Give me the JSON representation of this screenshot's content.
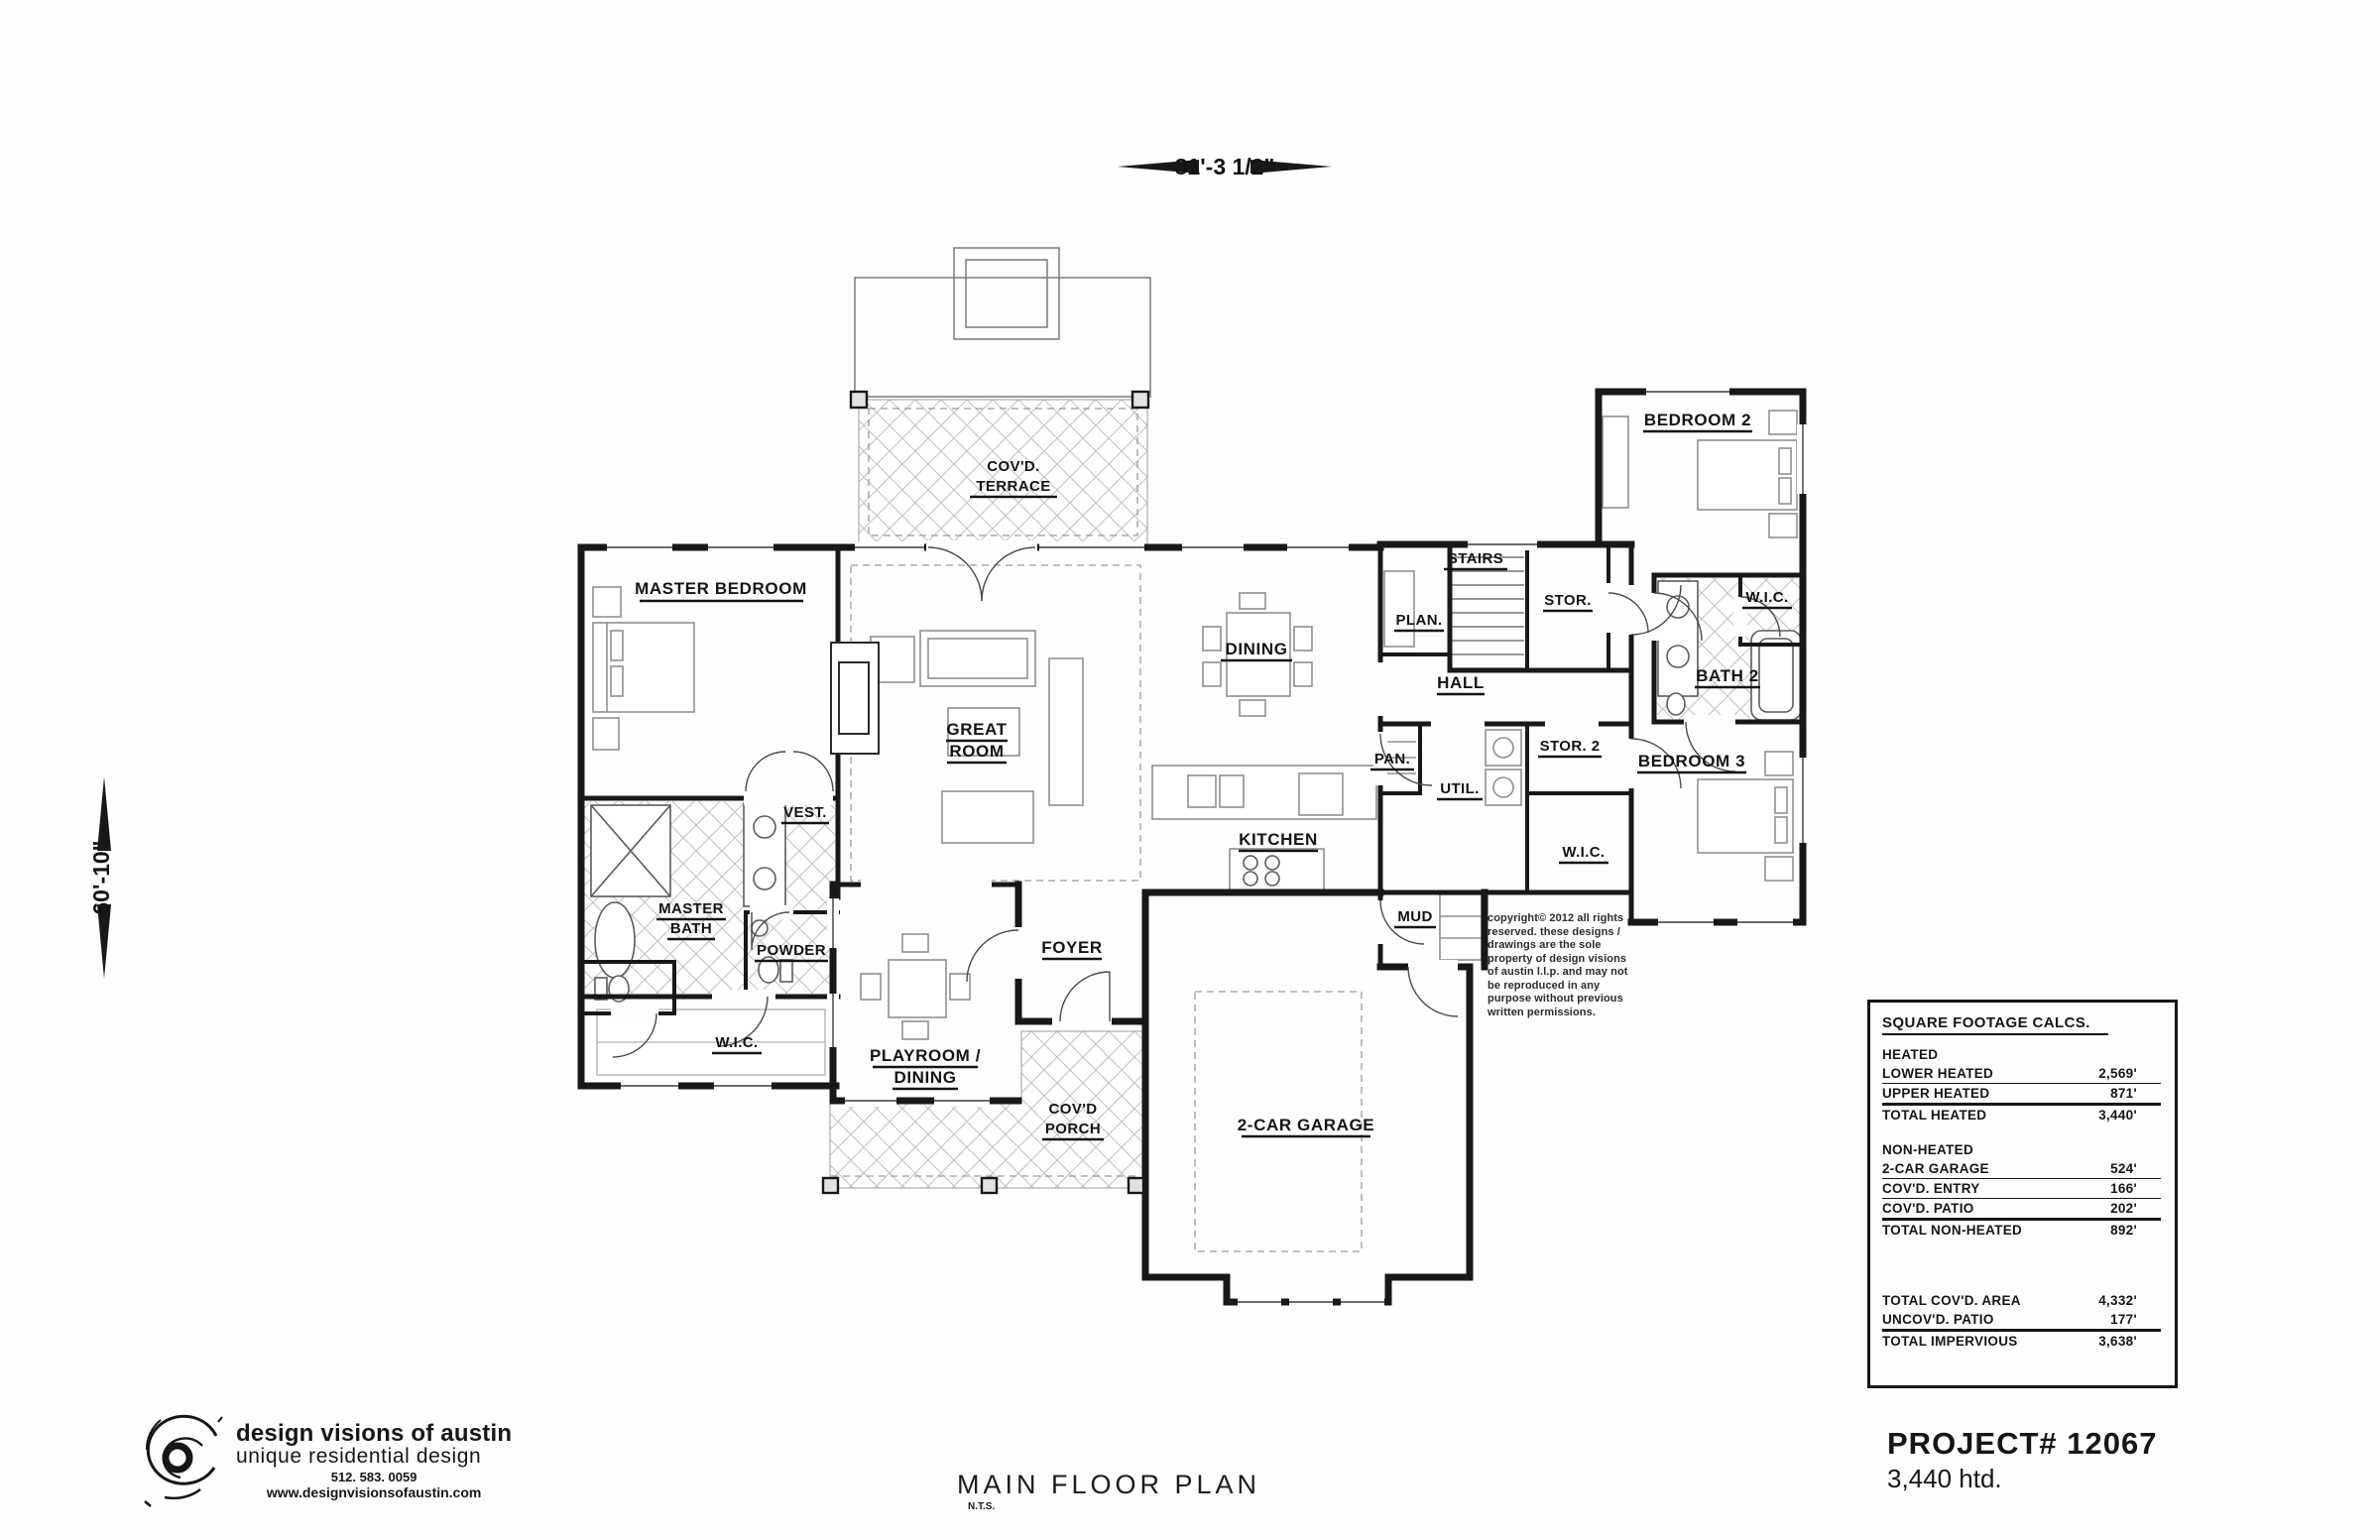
{
  "dimensions": {
    "width_top": "81'-3 1/2\"",
    "height_left": "60'-10\""
  },
  "rooms": {
    "master_bedroom": "MASTER BEDROOM",
    "covd_terrace": {
      "line1": "COV'D.",
      "line2": "TERRACE"
    },
    "great_room": {
      "line1": "GREAT",
      "line2": "ROOM"
    },
    "dining": "DINING",
    "stairs": "STAIRS",
    "plan_desk": "PLAN.",
    "stor": "STOR.",
    "hall": "HALL",
    "bedroom2": "BEDROOM 2",
    "wic_bedroom2": "W.I.C.",
    "bath2": "BATH 2",
    "pan": "PAN.",
    "util": "UTIL.",
    "stor2": "STOR. 2",
    "wic_hall": "W.I.C.",
    "bedroom3": "BEDROOM 3",
    "kitchen": "KITCHEN",
    "mud": "MUD",
    "vest": "VEST.",
    "master_bath": {
      "line1": "MASTER",
      "line2": "BATH"
    },
    "powder": "POWDER",
    "wic_master": "W.I.C.",
    "playroom_dining": {
      "line1": "PLAYROOM /",
      "line2": "DINING"
    },
    "foyer": "FOYER",
    "covd_porch": {
      "line1": "COV'D",
      "line2": "PORCH"
    },
    "garage": "2-CAR GARAGE"
  },
  "sqft_table": {
    "title": "SQUARE FOOTAGE CALCS.",
    "rows": [
      {
        "label": "HEATED",
        "value": ""
      },
      {
        "label": "LOWER HEATED",
        "value": "2,569'"
      },
      {
        "label": "UPPER HEATED",
        "value": "871'"
      },
      {
        "label": "TOTAL HEATED",
        "value": "3,440'"
      },
      {
        "label": "NON-HEATED",
        "value": ""
      },
      {
        "label": "2-CAR GARAGE",
        "value": "524'"
      },
      {
        "label": "COV'D. ENTRY",
        "value": "166'"
      },
      {
        "label": "COV'D. PATIO",
        "value": "202'"
      },
      {
        "label": "TOTAL NON-HEATED",
        "value": "892'"
      },
      {
        "label": "TOTAL COV'D. AREA",
        "value": "4,332'"
      },
      {
        "label": "UNCOV'D. PATIO",
        "value": "177'"
      },
      {
        "label": "TOTAL IMPERVIOUS",
        "value": "3,638'"
      }
    ]
  },
  "copyright": {
    "lines": [
      "copyright© 2012 all rights",
      "reserved.  these designs /",
      "drawings are the sole",
      "property of design visions",
      "of austin l.l.p. and may not",
      "be reproduced in any",
      "purpose without previous",
      "written permissions."
    ]
  },
  "plan_title": {
    "title": "MAIN FLOOR PLAN",
    "scale": "N.T.S."
  },
  "project": {
    "number": "PROJECT# 12067",
    "heated": "3,440 htd."
  },
  "logo": {
    "name": "design visions of austin",
    "tagline": "unique residential design",
    "phone": "512. 583. 0059",
    "website": "www.designvisionsofaustin.com"
  }
}
